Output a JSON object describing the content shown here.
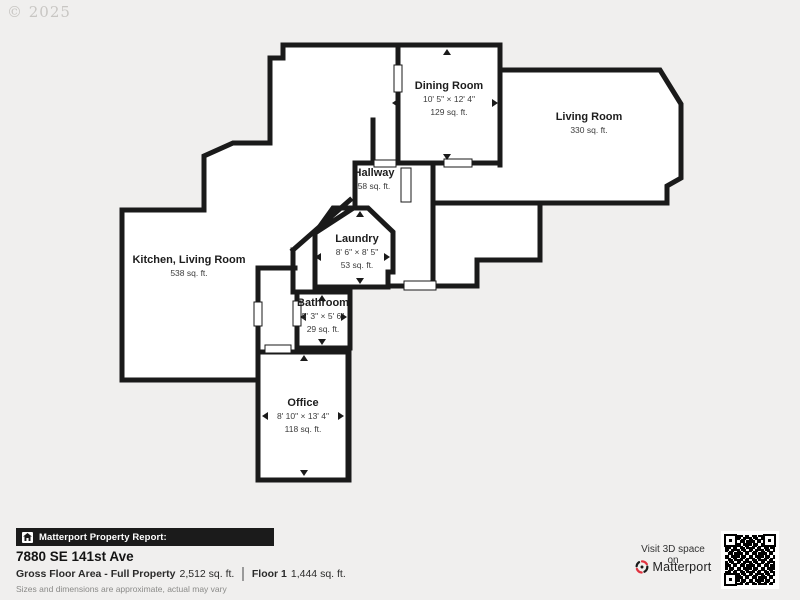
{
  "watermark": "© 2025",
  "colors": {
    "wall": "#1a1a1a",
    "background": "#f0efee",
    "floor": "#ffffff",
    "brand_accent": "#e0323f",
    "bar_background": "#1b1b1b"
  },
  "floor_plan": {
    "rooms": {
      "dining": {
        "name": "Dining Room",
        "dimensions": "10' 5\" × 12' 4\"",
        "area": "129 sq. ft."
      },
      "living": {
        "name": "Living Room",
        "area": "330 sq. ft."
      },
      "hallway": {
        "name": "Hallway",
        "area": "58 sq. ft."
      },
      "kitchen": {
        "name": "Kitchen, Living Room",
        "area": "538 sq. ft."
      },
      "laundry": {
        "name": "Laundry",
        "dimensions": "8' 6\" × 8' 5\"",
        "area": "53 sq. ft."
      },
      "bathroom": {
        "name": "Bathroom",
        "dimensions": "5' 3\" × 5' 6\"",
        "area": "29 sq. ft."
      },
      "office": {
        "name": "Office",
        "dimensions": "8' 10\" × 13' 4\"",
        "area": "118 sq. ft."
      }
    }
  },
  "footer": {
    "report_label": "Matterport Property Report:",
    "address": "7880 SE 141st Ave",
    "gross_floor_label": "Gross Floor Area - Full Property",
    "gross_floor_value": "2,512 sq. ft.",
    "floor1_label": "Floor 1",
    "floor1_value": "1,444 sq. ft.",
    "disclaimer": "Sizes and dimensions are approximate, actual may vary",
    "visit_label": "Visit 3D space on",
    "brand_name": "Matterport"
  }
}
